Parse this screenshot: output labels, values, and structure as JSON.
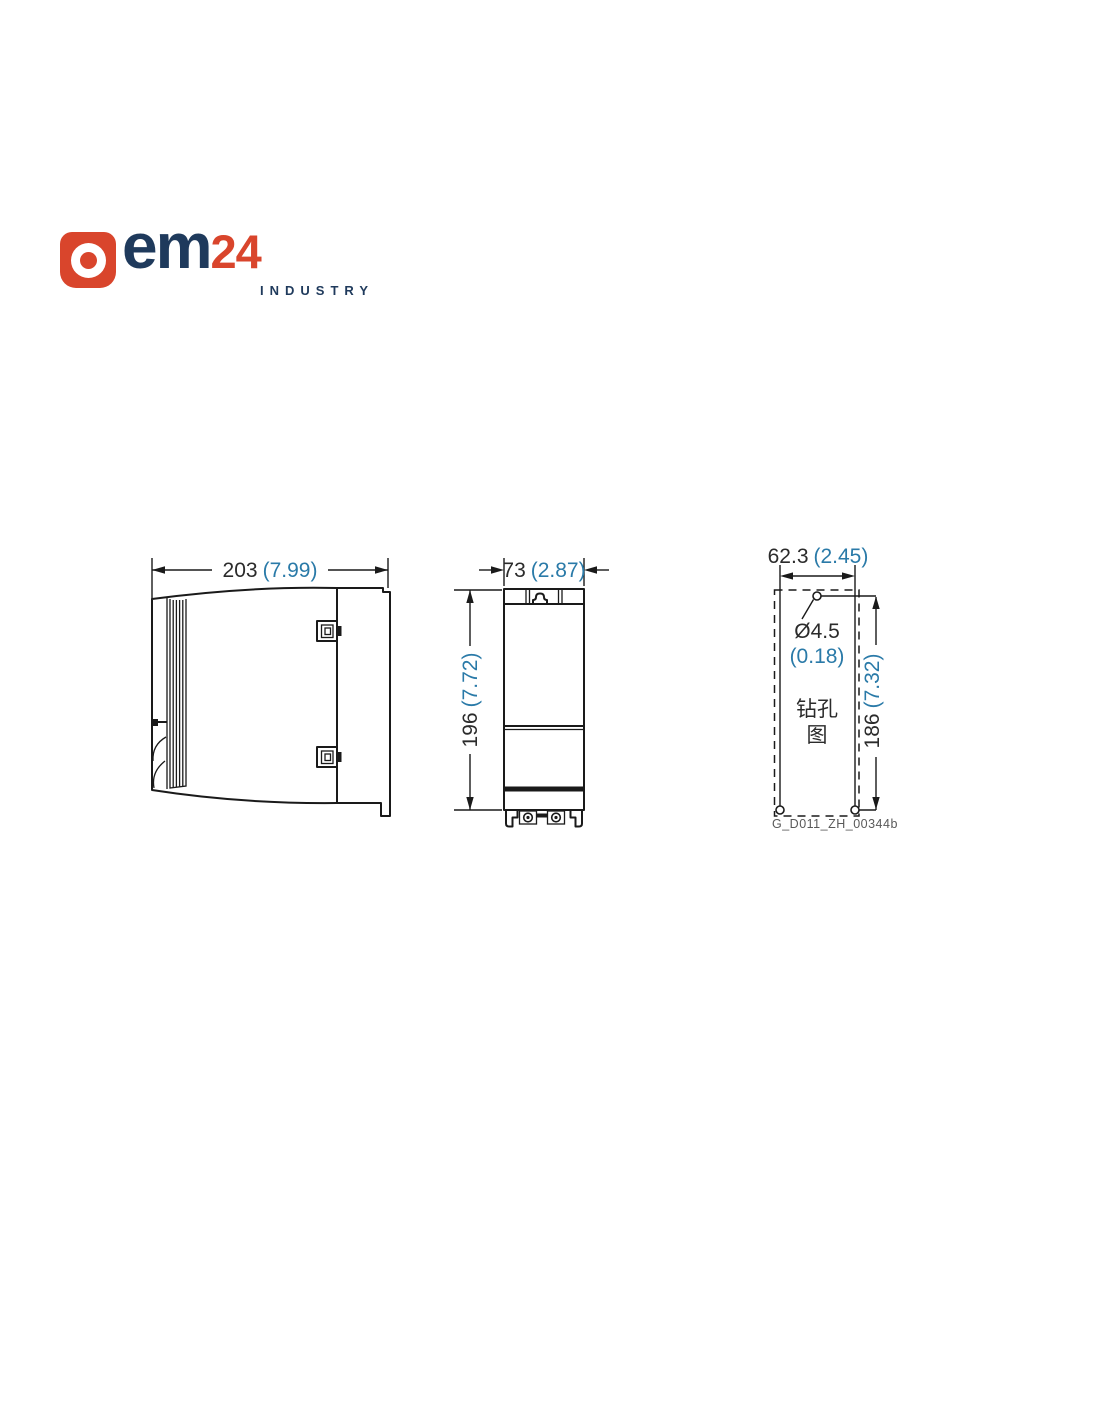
{
  "logo": {
    "icon": "ring-mark-icon",
    "text_em": "em",
    "text_24": "24",
    "tagline": "INDUSTRY",
    "colors": {
      "red": "#D9452C",
      "navy": "#1F3A5C"
    }
  },
  "drawing": {
    "colors": {
      "line": "#1a1a1a",
      "dim_text": "#2b2b2b",
      "inch_text": "#2A7AA8",
      "doc_label": "#595959"
    },
    "side_view": {
      "width_mm": "203",
      "width_in": "(7.99)"
    },
    "front_view": {
      "width_mm": "73",
      "width_in": "(2.87)",
      "height_mm": "196",
      "height_in": "(7.72)"
    },
    "drill_view": {
      "spacing_mm": "62.3",
      "spacing_in": "(2.45)",
      "hole_dia_mm": "Ø4.5",
      "hole_dia_in": "(0.18)",
      "height_mm": "186",
      "height_in": "(7.32)",
      "caption_line1": "钻孔",
      "caption_line2": "图",
      "doc_code": "G_D011_ZH_00344b"
    }
  }
}
